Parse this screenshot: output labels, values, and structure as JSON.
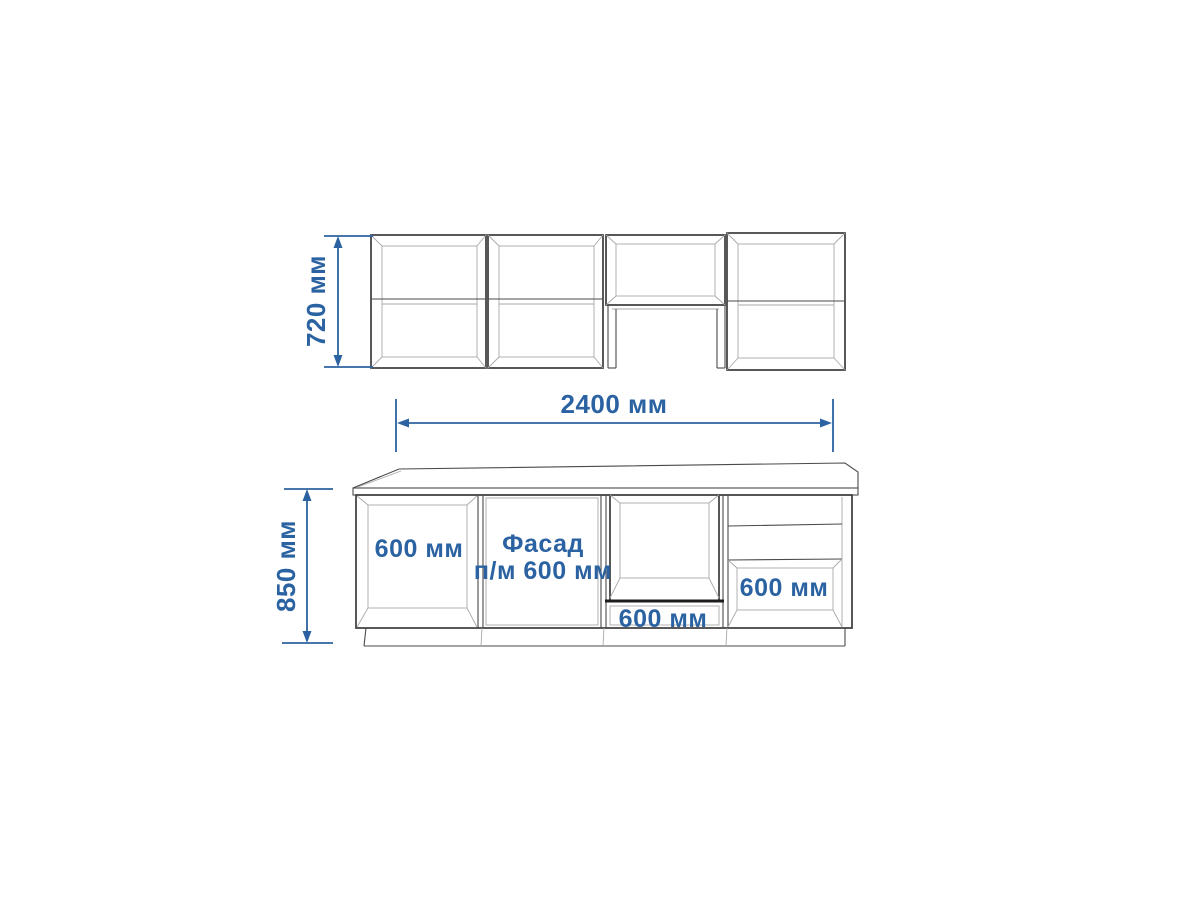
{
  "page": {
    "background": "#ffffff"
  },
  "drawing": {
    "colors": {
      "dimension_accent": "#2b62a1",
      "cabinet_outline": "#3b3b3b",
      "cabinet_detail": "#a9a9a9"
    },
    "upper_row": {
      "height_dimension": "720 мм"
    },
    "width_dimension": "2400 мм",
    "base_row": {
      "height_dimension": "850 мм",
      "open_cabinet_label": "600 мм",
      "facade_label_line1": "Фасад",
      "facade_label_line2": "п/м 600 мм",
      "oven_drawer_label": "600 мм",
      "drawer_cabinet_label": "600 мм"
    }
  }
}
